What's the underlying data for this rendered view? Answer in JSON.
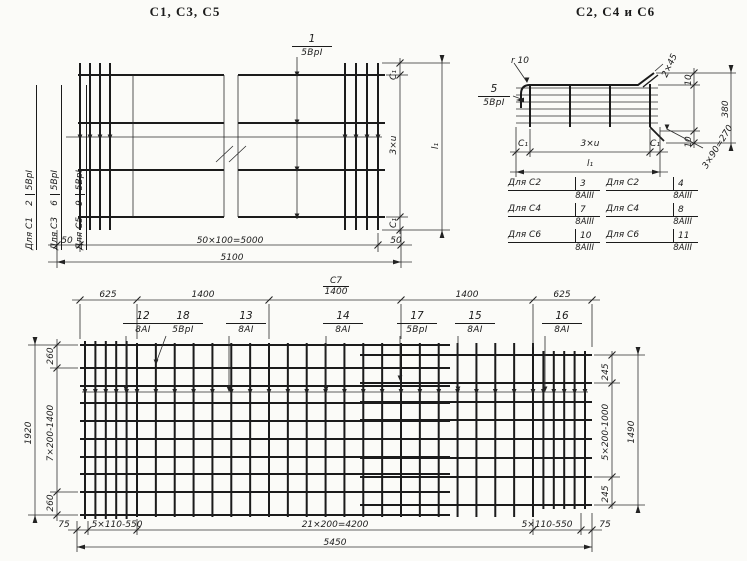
{
  "meta": {
    "paper_color": "#fbfbf8",
    "ink_color": "#1b1b1b"
  },
  "titles": {
    "left": "С1, С3, С5",
    "right": "С2, С4 и С6"
  },
  "tl": {
    "label1": {
      "num": "1",
      "cls": "5ВрI"
    },
    "rows": [
      {
        "for": "Для С1",
        "num": "2",
        "cls": "5ВрI"
      },
      {
        "for": "Для С3",
        "num": "6",
        "cls": "5ВрI"
      },
      {
        "for": "Для С5",
        "num": "9",
        "cls": "5ВрI"
      }
    ],
    "dim_50_left": "50",
    "dim_main": "50×100=5000",
    "dim_50_right": "50",
    "dim_total": "5100",
    "dim_side": [
      "С₁",
      "3×u",
      "С₁"
    ],
    "dim_side_total": "l₁"
  },
  "tr": {
    "r_label": "r 10",
    "label5": {
      "num": "5",
      "cls": "5ВрI"
    },
    "chamfer": "2×45",
    "d10_top": "10",
    "d380": "380",
    "d10_bot": "10",
    "d270": "3×90=270",
    "dim_side": [
      "С₁",
      "3×u",
      "С₁"
    ],
    "dim_side_total": "l₁",
    "table_left": [
      {
        "for": "Для С2",
        "num": "3",
        "cls": "8АIII"
      },
      {
        "for": "Для С4",
        "num": "7",
        "cls": "8АIII"
      },
      {
        "for": "Для С6",
        "num": "10",
        "cls": "8АIII"
      }
    ],
    "table_right": [
      {
        "for": "Для С2",
        "num": "4",
        "cls": "8АIII"
      },
      {
        "for": "Для С4",
        "num": "8",
        "cls": "8АIII"
      },
      {
        "for": "Для С6",
        "num": "11",
        "cls": "8АIII"
      }
    ]
  },
  "b": {
    "mark": "С7",
    "dims_top": [
      "625",
      "1400",
      "1400",
      "1400",
      "625"
    ],
    "labels": [
      {
        "num": "12",
        "cls": "8АI"
      },
      {
        "num": "18",
        "cls": "5ВрI"
      },
      {
        "num": "13",
        "cls": "8АI"
      },
      {
        "num": "14",
        "cls": "8АI"
      },
      {
        "num": "17",
        "cls": "5ВрI"
      },
      {
        "num": "15",
        "cls": "8АI"
      },
      {
        "num": "16",
        "cls": "8АI"
      }
    ],
    "dims_left": [
      "260",
      "7×200-1400",
      "260"
    ],
    "total_left": "1920",
    "dims_right": [
      "245",
      "5×200-1000",
      "245"
    ],
    "total_right": "1490",
    "dims_bottom": [
      "75",
      "5×110-550",
      "21×200=4200",
      "5×110-550",
      "75"
    ],
    "total_bottom": "5450"
  }
}
